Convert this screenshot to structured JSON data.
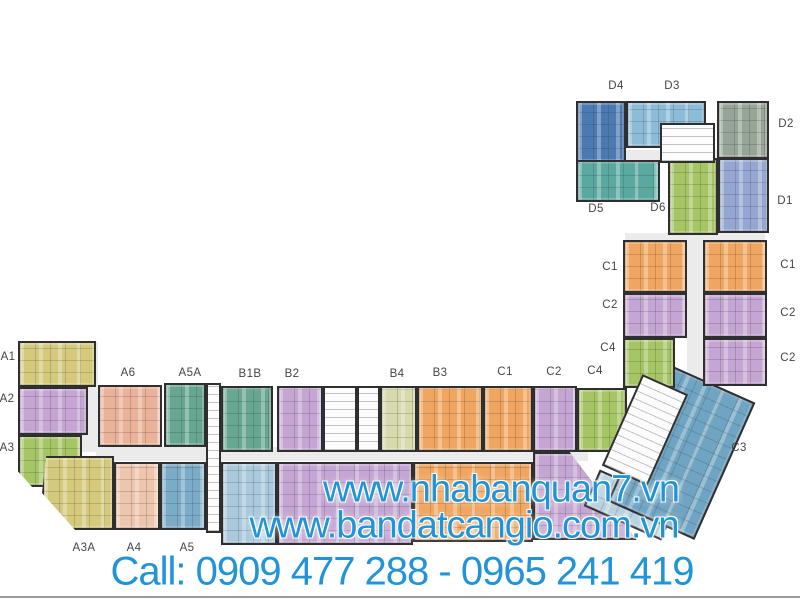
{
  "watermark": {
    "line1": "www.nhabanquan7.vn",
    "line2": "www.bandatcangio.com.vn",
    "line3": "Call: 0909 477 288 - 0965 241 419",
    "text_color": "#2094d6"
  },
  "unit_labels": {
    "d4": "D4",
    "d3": "D3",
    "d2": "D2",
    "d1": "D1",
    "d5": "D5",
    "d6": "D6",
    "c1_wing_left": "C1",
    "c1_wing_right": "C1",
    "c2_wing_left": "C2",
    "c2_wing_right_top": "C2",
    "c4_wing_left": "C4",
    "c2_wing_right_bottom": "C2",
    "a1": "A1",
    "a2": "A2",
    "a3": "A3",
    "a6": "A6",
    "a5a": "A5A",
    "b1b": "B1B",
    "b2": "B2",
    "b4": "B4",
    "b3": "B3",
    "c1_row": "C1",
    "c2_row": "C2",
    "c4_row": "C4",
    "a3a": "A3A",
    "a4": "A4",
    "a5": "A5",
    "c3": "C3"
  },
  "colors": {
    "olive": "#d5ca7c",
    "lavender": "#c5a5d3",
    "green": "#a6c565",
    "salmon": "#e9b299",
    "salmon_light": "#eec5ad",
    "teal": "#67a691",
    "steel_blue": "#7aabc7",
    "light_blue": "#aac9dd",
    "pale_yellow": "#d8d9ac",
    "orange": "#f0a660",
    "sky_blue": "#8dbcd9",
    "sage": "#96a595",
    "periwinkle": "#94a6d1",
    "dark_blue": "#4b7ab1",
    "teal_dark": "#5aa9a1",
    "c3_blue": "#70a4c3",
    "c3_light": "#b7d0df",
    "corridor": "#ebebeb",
    "core": "#fcfcfc",
    "wall": "#2f2f2f",
    "label_text": "#454545"
  }
}
